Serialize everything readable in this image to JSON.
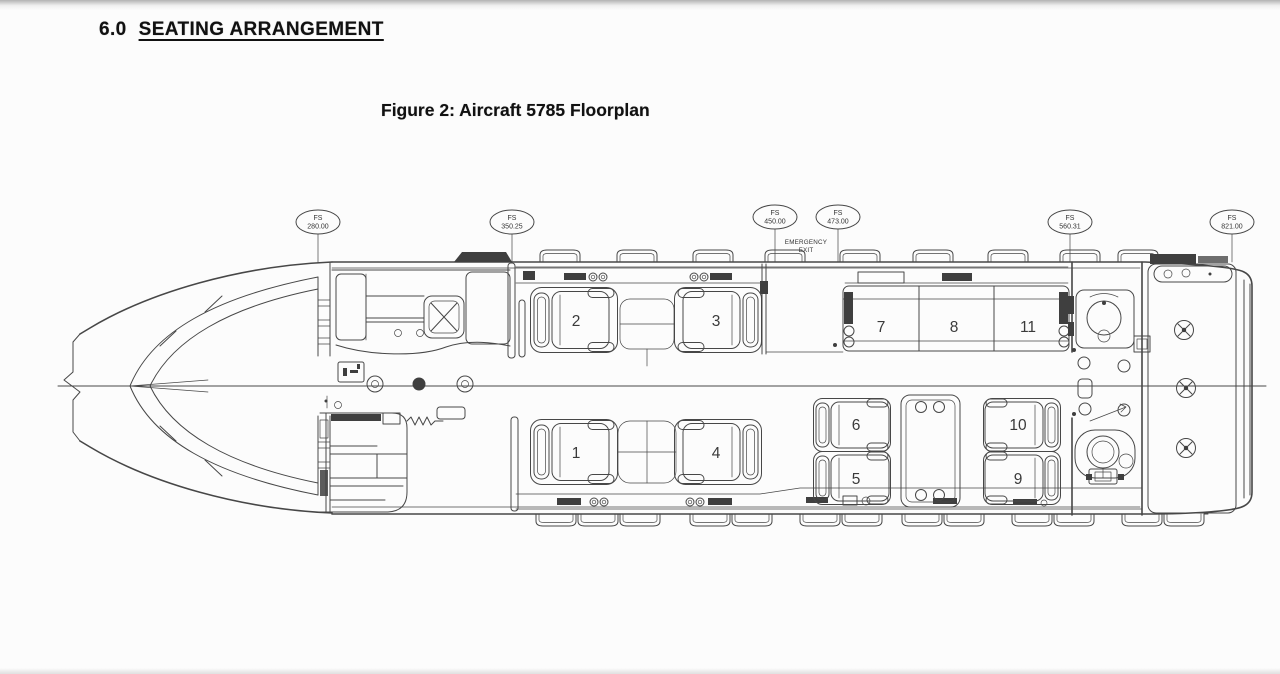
{
  "page": {
    "section_number": "6.0",
    "section_title": "SEATING ARRANGEMENT",
    "figure_caption": "Figure 2: Aircraft 5785 Floorplan"
  },
  "floorplan": {
    "stations": [
      {
        "label": "FS",
        "value": "280.00"
      },
      {
        "label": "FS",
        "value": "350.25"
      },
      {
        "label": "FS",
        "value": "450.00"
      },
      {
        "label": "FS",
        "value": "473.00"
      },
      {
        "label": "FS",
        "value": "560.31"
      },
      {
        "label": "FS",
        "value": "821.00"
      }
    ],
    "emergency_exit": {
      "line1": "EMERGENCY",
      "line2": "EXIT"
    },
    "seats": {
      "singles": [
        {
          "number": "1"
        },
        {
          "number": "2"
        },
        {
          "number": "3"
        },
        {
          "number": "4"
        }
      ],
      "divan": [
        {
          "number": "7"
        },
        {
          "number": "8"
        },
        {
          "number": "11"
        }
      ],
      "club": [
        {
          "number": "6"
        },
        {
          "number": "5"
        },
        {
          "number": "10"
        },
        {
          "number": "9"
        }
      ]
    },
    "colors": {
      "paper": "#fcfcfc",
      "ink": "#474747",
      "text": "#111111"
    }
  }
}
